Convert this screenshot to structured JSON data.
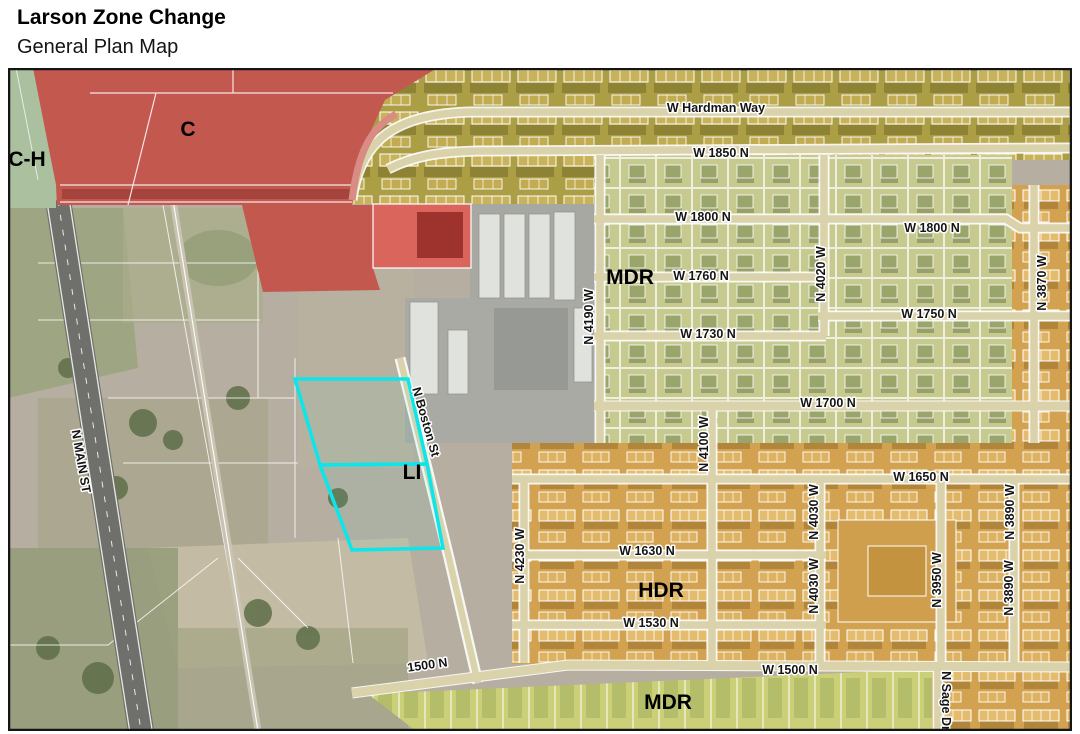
{
  "header": {
    "title": "Larson Zone Change",
    "subtitle": "General Plan Map"
  },
  "map": {
    "zone_labels": [
      {
        "code": "C-H",
        "text": "C-H"
      },
      {
        "code": "C",
        "text": "C"
      },
      {
        "code": "MDR",
        "text": "MDR"
      },
      {
        "code": "LI",
        "text": "LI"
      },
      {
        "code": "HDR",
        "text": "HDR"
      },
      {
        "code": "MDR",
        "text": "MDR"
      }
    ],
    "street_labels": [
      {
        "text": "W Hardman Way"
      },
      {
        "text": "W 1850 N"
      },
      {
        "text": "W 1800 N"
      },
      {
        "text": "W 1800 N"
      },
      {
        "text": "W 1760 N"
      },
      {
        "text": "W 1750 N"
      },
      {
        "text": "W 1730 N"
      },
      {
        "text": "W 1700 N"
      },
      {
        "text": "W 1650 N"
      },
      {
        "text": "W 1630 N"
      },
      {
        "text": "W 1530 N"
      },
      {
        "text": "W 1500 N"
      },
      {
        "text": "1500 N"
      },
      {
        "text": "N MAIN ST"
      },
      {
        "text": "N Boston St"
      },
      {
        "text": "N 4190 W"
      },
      {
        "text": "N 4020 W"
      },
      {
        "text": "N 3870 W"
      },
      {
        "text": "N 4100 W"
      },
      {
        "text": "N 4230 W"
      },
      {
        "text": "N 4030 W"
      },
      {
        "text": "N 4030 W"
      },
      {
        "text": "N 3950 W"
      },
      {
        "text": "N 3890 W"
      },
      {
        "text": "N 3890 W"
      },
      {
        "text": "N Sage Dr"
      }
    ],
    "zone_colors": {
      "commercial_highway_green": "#abc09f",
      "commercial_red": "#c3584f",
      "commercial_highlight_red": "#da655d",
      "mdr_olive": "#ab9e44",
      "mdr_green": "#c6ca8f",
      "mdr_strip": "#cbd078",
      "hdr_orange": "#d2a250",
      "subject_parcel_cyan": "#0be6ea"
    }
  }
}
